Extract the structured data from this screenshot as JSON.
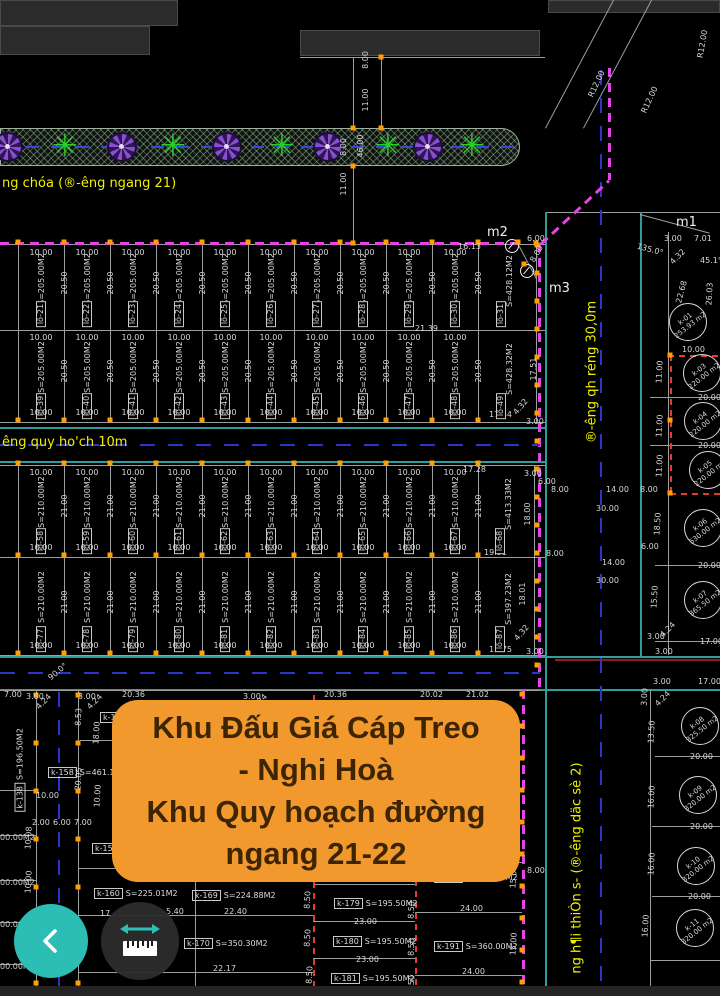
{
  "overlay": {
    "lines": [
      "Khu Đấu Giá Cáp Treo",
      "- Nghi Hoà",
      "Khu Quy hoạch đường",
      "ngang 21-22"
    ]
  },
  "colors": {
    "background": "#000000",
    "accent_orange": "#F2992D",
    "overlay_text": "#3D2403",
    "teal_button": "#2CBDB5",
    "dark_button": "#2E2E2E",
    "magenta": "#E445E4",
    "red": "#E53935",
    "centerline_blue": "#2B35C8",
    "road_cyan": "#2F9D9D",
    "label_yellow": "#F0F000",
    "line_gray": "#9AA0A0",
    "marker_orange": "#FFA000",
    "tree_green": "#26D026",
    "flower_purple": "#8A4FD0"
  },
  "drawing": {
    "rows": [
      {
        "y": 245,
        "h": 85,
        "x0": 18,
        "pw": 46,
        "width_dim": "10.00",
        "depth_dim": "20.50",
        "area": "S=205.00M2",
        "dims": [
          "top"
        ],
        "plots": [
          "lô-21",
          "lô-22",
          "lô-23",
          "lô-24",
          "lô-25",
          "lô-26",
          "lô-27",
          "lô-28",
          "lô-29",
          "lô-30"
        ],
        "big": {
          "id": "lô-31",
          "area": "S=428.12M2",
          "x": 478,
          "w": 58
        }
      },
      {
        "y": 330,
        "h": 92,
        "x0": 18,
        "pw": 46,
        "width_dim": "10.00",
        "depth_dim": "20.50",
        "area": "S=205.00M2",
        "dims": [
          "top",
          "bottom"
        ],
        "plots": [
          "lô-39",
          "lô-40",
          "lô-41",
          "lô-42",
          "lô-43",
          "lô-44",
          "lô-45",
          "lô-46",
          "lô-47",
          "lô-48"
        ],
        "big": {
          "id": "lô-49",
          "area": "S=428.32M2",
          "x": 478,
          "w": 58
        }
      },
      {
        "y": 465,
        "h": 92,
        "x0": 18,
        "pw": 46,
        "width_dim": "10.00",
        "depth_dim": "21.00",
        "area": "S=210.00M2",
        "dims": [
          "top",
          "bottom"
        ],
        "plots": [
          "lô-58",
          "lô-59",
          "lô-60",
          "lô-61",
          "lô-62",
          "lô-63",
          "lô-64",
          "lô-65",
          "lô-66",
          "lô-67"
        ],
        "big": {
          "id": "lô-68",
          "area": "S=413.33M2",
          "x": 478,
          "w": 56
        }
      },
      {
        "y": 558,
        "h": 97,
        "x0": 18,
        "pw": 46,
        "width_dim": "10.00",
        "depth_dim": "21.00",
        "area": "S=210.00M2",
        "dims": [
          "bottom"
        ],
        "plots": [
          "lô-77",
          "lô-78",
          "lô-79",
          "lô-80",
          "lô-81",
          "lô-82",
          "lô-83",
          "lô-84",
          "lô-85",
          "lô-86"
        ],
        "big": {
          "id": "lô-87",
          "area": "S=397.23M2",
          "x": 478,
          "w": 56
        }
      }
    ],
    "circles": [
      {
        "id": "k-01",
        "area": "253.93 m2",
        "x": 688,
        "y": 322
      },
      {
        "id": "k-03",
        "area": "220.00 m2",
        "x": 702,
        "y": 373
      },
      {
        "id": "k-04",
        "area": "220.00 m2",
        "x": 703,
        "y": 421
      },
      {
        "id": "k-05",
        "area": "220.00 m2",
        "x": 708,
        "y": 470
      },
      {
        "id": "k-06",
        "area": "530.00 m2",
        "x": 703,
        "y": 528
      },
      {
        "id": "k-07",
        "area": "365.50 m2",
        "x": 703,
        "y": 600
      },
      {
        "id": "k-08",
        "area": "325.50 m2",
        "x": 700,
        "y": 726
      },
      {
        "id": "k-09",
        "area": "320.00 m2",
        "x": 698,
        "y": 795
      },
      {
        "id": "k-10",
        "area": "320.00 m2",
        "x": 696,
        "y": 866
      },
      {
        "id": "k-11",
        "area": "320.00 m2",
        "x": 695,
        "y": 928
      }
    ],
    "parcels": [
      {
        "id": "k-157",
        "area": "",
        "x": 100,
        "y": 712
      },
      {
        "id": "k-158",
        "area": "S=461.18M2",
        "x": 48,
        "y": 767
      },
      {
        "id": "k-159",
        "area": "S=227.84M2",
        "x": 92,
        "y": 843
      },
      {
        "id": "k-160",
        "area": "S=225.01M2",
        "x": 94,
        "y": 888
      },
      {
        "id": "k-169",
        "area": "S=224.88M2",
        "x": 192,
        "y": 890
      },
      {
        "id": "k-170",
        "area": "S=350.30M2",
        "x": 184,
        "y": 938
      },
      {
        "id": "k-179",
        "area": "S=195.50M2",
        "x": 334,
        "y": 898
      },
      {
        "id": "k-180",
        "area": "S=195.50M2",
        "x": 333,
        "y": 936
      },
      {
        "id": "k-181",
        "area": "S=195.50M2",
        "x": 331,
        "y": 973
      },
      {
        "id": "k-190",
        "area": "S=360.00M2",
        "x": 434,
        "y": 872
      },
      {
        "id": "k-191",
        "area": "S=360.00M2",
        "x": 434,
        "y": 941
      },
      {
        "id": "k-138",
        "area": "S=196.50M2",
        "x": 20,
        "y": 770,
        "rot": true
      }
    ],
    "trees": {
      "flower_x": [
        8,
        122,
        227,
        328,
        428
      ],
      "star_x": [
        65,
        173,
        282,
        388,
        472
      ]
    },
    "annotations": [
      {
        "t": "8.00",
        "x": 366,
        "y": 60,
        "r": -90
      },
      {
        "t": "11.00",
        "x": 366,
        "y": 100,
        "r": -90
      },
      {
        "t": "8.00",
        "x": 344,
        "y": 147,
        "r": -90
      },
      {
        "t": "46.00",
        "x": 361,
        "y": 146,
        "r": -90
      },
      {
        "t": "11.00",
        "x": 344,
        "y": 184,
        "r": -90
      },
      {
        "t": "R12.00",
        "x": 597,
        "y": 84,
        "r": -65
      },
      {
        "t": "R12.00",
        "x": 650,
        "y": 100,
        "r": -65
      },
      {
        "t": "R12.00",
        "x": 703,
        "y": 44,
        "r": -80
      },
      {
        "t": "m2",
        "x": 487,
        "y": 226,
        "c": "big"
      },
      {
        "t": "m3",
        "x": 549,
        "y": 282,
        "c": "big"
      },
      {
        "t": "m1",
        "x": 676,
        "y": 216,
        "c": "big"
      },
      {
        "t": "6.00",
        "x": 527,
        "y": 235
      },
      {
        "t": "8.00",
        "x": 537,
        "y": 254,
        "r": -60
      },
      {
        "t": "16.13",
        "x": 458,
        "y": 243
      },
      {
        "t": "21.39",
        "x": 415,
        "y": 325
      },
      {
        "t": "3.00",
        "x": 664,
        "y": 235
      },
      {
        "t": "7.01",
        "x": 694,
        "y": 235
      },
      {
        "t": "4.32",
        "x": 678,
        "y": 257,
        "r": -45
      },
      {
        "t": "135.0°",
        "x": 650,
        "y": 250,
        "r": 15
      },
      {
        "t": "45.1°",
        "x": 700,
        "y": 257
      },
      {
        "t": "17.51",
        "x": 534,
        "y": 369,
        "r": -90
      },
      {
        "t": "4.32",
        "x": 521,
        "y": 407,
        "r": -50
      },
      {
        "t": "3.00",
        "x": 526,
        "y": 418
      },
      {
        "t": "17.84",
        "x": 489,
        "y": 411
      },
      {
        "t": "17.28",
        "x": 463,
        "y": 466
      },
      {
        "t": "3.00",
        "x": 524,
        "y": 470
      },
      {
        "t": "6.00",
        "x": 538,
        "y": 478
      },
      {
        "t": "8.00",
        "x": 551,
        "y": 486
      },
      {
        "t": "18.00",
        "x": 528,
        "y": 514,
        "r": -90
      },
      {
        "t": "8.00",
        "x": 546,
        "y": 550
      },
      {
        "t": "19.51",
        "x": 484,
        "y": 549
      },
      {
        "t": "14.00",
        "x": 606,
        "y": 486
      },
      {
        "t": "30.00",
        "x": 596,
        "y": 505
      },
      {
        "t": "14.00",
        "x": 602,
        "y": 559
      },
      {
        "t": "30.00",
        "x": 596,
        "y": 577
      },
      {
        "t": "18.01",
        "x": 523,
        "y": 594,
        "r": -90
      },
      {
        "t": "4.32",
        "x": 522,
        "y": 633,
        "r": -50
      },
      {
        "t": "3.00",
        "x": 526,
        "y": 648
      },
      {
        "t": "15.75",
        "x": 489,
        "y": 646
      },
      {
        "t": "22.68",
        "x": 682,
        "y": 292,
        "r": -75
      },
      {
        "t": "26.03",
        "x": 710,
        "y": 294,
        "r": -87
      },
      {
        "t": "10.00",
        "x": 682,
        "y": 346
      },
      {
        "t": "11.00",
        "x": 660,
        "y": 372,
        "r": -87
      },
      {
        "t": "11.00",
        "x": 660,
        "y": 426,
        "r": -87
      },
      {
        "t": "11.00",
        "x": 660,
        "y": 466,
        "r": -87
      },
      {
        "t": "8.00",
        "x": 640,
        "y": 486
      },
      {
        "t": "20.00",
        "x": 698,
        "y": 394
      },
      {
        "t": "20.00",
        "x": 698,
        "y": 442
      },
      {
        "t": "18.50",
        "x": 658,
        "y": 524,
        "r": -87
      },
      {
        "t": "6.00",
        "x": 641,
        "y": 543
      },
      {
        "t": "20.00",
        "x": 698,
        "y": 562
      },
      {
        "t": "15.50",
        "x": 655,
        "y": 597,
        "r": -87
      },
      {
        "t": "3.00",
        "x": 647,
        "y": 633
      },
      {
        "t": "4.24",
        "x": 668,
        "y": 630,
        "r": -45
      },
      {
        "t": "17.00",
        "x": 700,
        "y": 638
      },
      {
        "t": "3.00",
        "x": 655,
        "y": 648
      },
      {
        "t": "3.00",
        "x": 653,
        "y": 678
      },
      {
        "t": "17.00",
        "x": 698,
        "y": 678
      },
      {
        "t": "3.00",
        "x": 645,
        "y": 697,
        "r": -87
      },
      {
        "t": "4.24",
        "x": 663,
        "y": 699,
        "r": -45
      },
      {
        "t": "13.50",
        "x": 652,
        "y": 732,
        "r": -87
      },
      {
        "t": "20.00",
        "x": 690,
        "y": 753
      },
      {
        "t": "16.00",
        "x": 652,
        "y": 797,
        "r": -87
      },
      {
        "t": "20.00",
        "x": 690,
        "y": 823
      },
      {
        "t": "16.00",
        "x": 652,
        "y": 864,
        "r": -87
      },
      {
        "t": "20.00",
        "x": 688,
        "y": 893
      },
      {
        "t": "16.00",
        "x": 646,
        "y": 926,
        "r": -87
      },
      {
        "t": "90.0°",
        "x": 58,
        "y": 672,
        "r": -40
      },
      {
        "t": "7.00",
        "x": 4,
        "y": 691
      },
      {
        "t": "3.00",
        "x": 26,
        "y": 693
      },
      {
        "t": "4.24",
        "x": 44,
        "y": 702,
        "r": -45
      },
      {
        "t": "3.00",
        "x": 78,
        "y": 693
      },
      {
        "t": "4.24",
        "x": 95,
        "y": 702,
        "r": -45
      },
      {
        "t": "20.36",
        "x": 122,
        "y": 691
      },
      {
        "t": "3.00",
        "x": 243,
        "y": 693
      },
      {
        "t": "4.24",
        "x": 260,
        "y": 702,
        "r": -45
      },
      {
        "t": "20.36",
        "x": 324,
        "y": 691
      },
      {
        "t": "20.02",
        "x": 420,
        "y": 691
      },
      {
        "t": "21.02",
        "x": 466,
        "y": 691
      },
      {
        "t": "8.53",
        "x": 79,
        "y": 717,
        "r": -87
      },
      {
        "t": "18.00",
        "x": 97,
        "y": 733,
        "r": -87
      },
      {
        "t": "20.05",
        "x": 79,
        "y": 779,
        "r": -87
      },
      {
        "t": "10.00",
        "x": 98,
        "y": 796,
        "r": -87
      },
      {
        "t": "10.00",
        "x": 36,
        "y": 792
      },
      {
        "t": "2.00",
        "x": 32,
        "y": 819
      },
      {
        "t": "6.00",
        "x": 53,
        "y": 819
      },
      {
        "t": "7.00",
        "x": 74,
        "y": 819
      },
      {
        "t": "10.08",
        "x": 29,
        "y": 838,
        "r": -87
      },
      {
        "t": "10.00",
        "x": 29,
        "y": 882,
        "r": -87
      },
      {
        "t": "00.00M2",
        "x": 0,
        "y": 834,
        "c": "part"
      },
      {
        "t": "00.00M2",
        "x": 0,
        "y": 879,
        "c": "part"
      },
      {
        "t": "00.00M2",
        "x": 0,
        "y": 921,
        "c": "part"
      },
      {
        "t": "00.00M2",
        "x": 0,
        "y": 963,
        "c": "part"
      },
      {
        "t": "22.59",
        "x": 124,
        "y": 861
      },
      {
        "t": "17.",
        "x": 100,
        "y": 910
      },
      {
        "t": "5.40",
        "x": 166,
        "y": 908
      },
      {
        "t": "22.40",
        "x": 224,
        "y": 908
      },
      {
        "t": "22.17",
        "x": 213,
        "y": 965
      },
      {
        "t": "23.00",
        "x": 354,
        "y": 918
      },
      {
        "t": "23.00",
        "x": 356,
        "y": 956
      },
      {
        "t": "24.00",
        "x": 460,
        "y": 905
      },
      {
        "t": "24.00",
        "x": 462,
        "y": 968
      },
      {
        "t": "8.00",
        "x": 527,
        "y": 867
      },
      {
        "t": "15.00",
        "x": 514,
        "y": 877,
        "r": -87
      },
      {
        "t": "15.00",
        "x": 514,
        "y": 944,
        "r": -87
      },
      {
        "t": "8.50",
        "x": 308,
        "y": 900,
        "r": -87
      },
      {
        "t": "8.50",
        "x": 308,
        "y": 938,
        "r": -87
      },
      {
        "t": "8.50",
        "x": 310,
        "y": 975,
        "r": -87
      },
      {
        "t": "8.50",
        "x": 412,
        "y": 910,
        "r": -87
      },
      {
        "t": "8.50",
        "x": 412,
        "y": 947,
        "r": -87
      },
      {
        "t": "8.50",
        "x": 412,
        "y": 984,
        "r": -87
      },
      {
        "t": "ng chóa (®-êng ngang 21)",
        "x": 2,
        "y": 177,
        "c": "street"
      },
      {
        "t": "êng quy ho'ch 10m",
        "x": 2,
        "y": 436,
        "c": "street"
      },
      {
        "t": "®-êng qh réng 30,0m",
        "x": 592,
        "y": 372,
        "r": -90,
        "c": "street"
      },
      {
        "t": "ng h¶i thiÒn s- (®-êng däc sè 2)",
        "x": 577,
        "y": 868,
        "r": -90,
        "c": "street"
      }
    ]
  }
}
